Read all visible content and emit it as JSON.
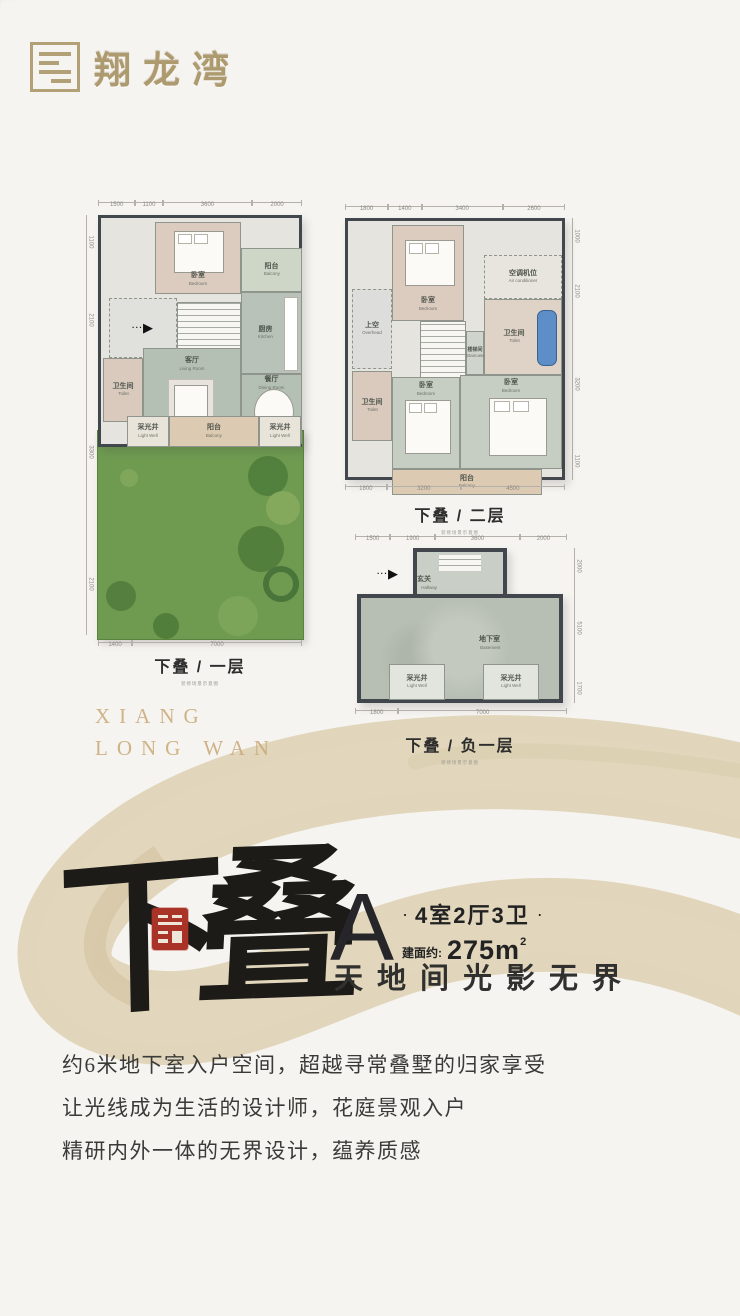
{
  "logo": {
    "name_zh": "翔龙湾",
    "en_line1": "XIANG",
    "en_line2": "LONG WAN"
  },
  "entry_arrow": "▶",
  "entry_dots": "···",
  "plans": [
    {
      "caption": "下叠 / 一层",
      "disclaimer": "装修场景示意图",
      "dims_top": [
        "1500",
        "1100",
        "3600",
        "2000"
      ],
      "dims_left": [
        "1100",
        "2100",
        "3300",
        "2100"
      ],
      "dims_bottom": [
        "1400",
        "7000"
      ],
      "rooms": [
        {
          "zh": "卧室",
          "en": "Bedroom"
        },
        {
          "zh": "阳台",
          "en": "Balcony"
        },
        {
          "zh": "厨房",
          "en": "Kitchen"
        },
        {
          "zh": "卫生间",
          "en": "Toilet"
        },
        {
          "zh": "客厅",
          "en": "Living Room"
        },
        {
          "zh": "餐厅",
          "en": "Dining Room"
        },
        {
          "zh": "采光井",
          "en": "Light Well"
        },
        {
          "zh": "阳台",
          "en": "Balcony"
        },
        {
          "zh": "采光井",
          "en": "Light Well"
        }
      ]
    },
    {
      "caption": "下叠 / 二层",
      "disclaimer": "装修场景示意图",
      "dims_top": [
        "1800",
        "1400",
        "3400",
        "2600"
      ],
      "dims_right": [
        "1000",
        "2100",
        "3200",
        "1100"
      ],
      "dims_bottom": [
        "1800",
        "3200",
        "4500"
      ],
      "rooms": [
        {
          "zh": "卧室",
          "en": "Bedroom"
        },
        {
          "zh": "空调机位",
          "en": "Air conditioner"
        },
        {
          "zh": "卫生间",
          "en": "Toilet"
        },
        {
          "zh": "上空",
          "en": "Overhead"
        },
        {
          "zh": "楼梯间",
          "en": "Staircase"
        },
        {
          "zh": "卫生间",
          "en": "Toilet"
        },
        {
          "zh": "卧室",
          "en": "Bedroom"
        },
        {
          "zh": "卧室",
          "en": "Bedroom"
        },
        {
          "zh": "阳台",
          "en": "Balcony"
        }
      ]
    },
    {
      "caption": "下叠 / 负一层",
      "disclaimer": "装修场景示意图",
      "dims_top": [
        "1500",
        "1900",
        "3600",
        "2000"
      ],
      "dims_right": [
        "2000",
        "5100",
        "1700"
      ],
      "dims_bottom": [
        "1800",
        "7000"
      ],
      "rooms": [
        {
          "zh": "玄关",
          "en": "Hallway"
        },
        {
          "zh": "地下室",
          "en": "Basement"
        },
        {
          "zh": "采光井",
          "en": "Light Well"
        },
        {
          "zh": "采光井",
          "en": "Light Well"
        }
      ]
    }
  ],
  "headline": {
    "calligraphy_1": "下",
    "calligraphy_2": "叠",
    "unit": "A",
    "dot": "·",
    "layout": "4室2厅3卫",
    "area_label": "建面约:",
    "area_value": "275m",
    "area_sup": "2",
    "slogan": "天地间光影无界"
  },
  "description": {
    "line1": "约6米地下室入户空间，超越寻常叠墅的归家享受",
    "line2": "让光线成为生活的设计师，花庭景观入户",
    "line3": "精研内外一体的无界设计，蕴养质感"
  },
  "colors": {
    "gold": "#ad9a6e",
    "seal_red": "#a93327",
    "ink": "#1d1b18",
    "brush_beige": "#d9cbaa",
    "garden_green": "#6f9b51"
  }
}
